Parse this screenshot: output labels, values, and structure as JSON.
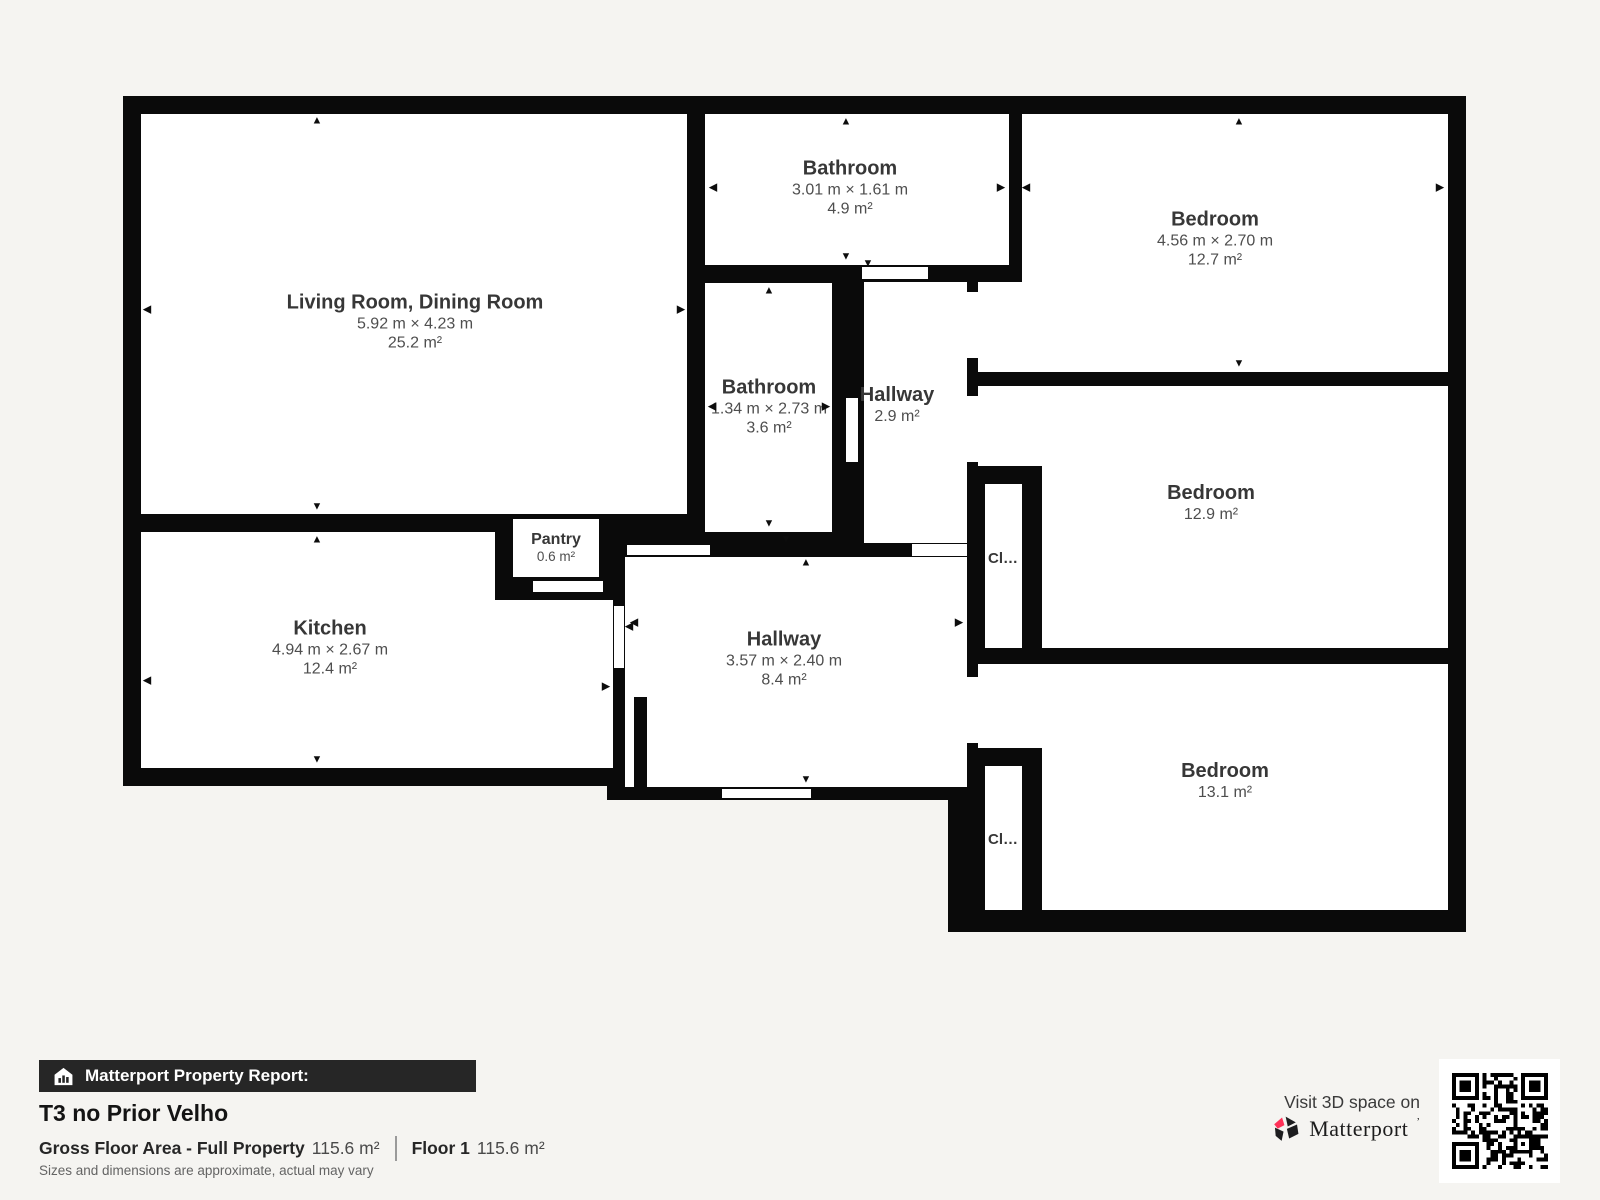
{
  "colors": {
    "wall": "#0a0a0a",
    "background": "#f5f4f1",
    "accent_pink": "#ff3158",
    "footer_bar": "#262626"
  },
  "footer": {
    "report_label": "Matterport Property Report:",
    "title": "T3 no Prior Velho",
    "gfa_label": "Gross Floor Area - Full Property",
    "gfa_value": "115.6 m²",
    "floor_label": "Floor 1",
    "floor_value": "115.6 m²",
    "disclaimer": "Sizes and dimensions are approximate, actual may vary",
    "visit_text": "Visit 3D space on",
    "brand": "Matterport",
    "brand_mark": "’"
  },
  "plan": {
    "black": [
      {
        "x": 123,
        "y": 96,
        "w": 1343,
        "h": 690
      },
      {
        "x": 948,
        "y": 96,
        "w": 518,
        "h": 836
      },
      {
        "x": 607,
        "y": 530,
        "w": 376,
        "h": 270
      }
    ],
    "white": [
      {
        "x": 141,
        "y": 114,
        "w": 546,
        "h": 400
      },
      {
        "x": 141,
        "y": 532,
        "w": 354,
        "h": 236
      },
      {
        "x": 141,
        "y": 600,
        "w": 472,
        "h": 168
      },
      {
        "x": 513,
        "y": 519,
        "w": 86,
        "h": 58
      },
      {
        "x": 705,
        "y": 114,
        "w": 304,
        "h": 151
      },
      {
        "x": 705,
        "y": 283,
        "w": 127,
        "h": 249
      },
      {
        "x": 864,
        "y": 282,
        "w": 103,
        "h": 261
      },
      {
        "x": 625,
        "y": 557,
        "w": 342,
        "h": 230
      },
      {
        "x": 978,
        "y": 282,
        "w": 44,
        "h": 90
      },
      {
        "x": 1022,
        "y": 114,
        "w": 426,
        "h": 258
      },
      {
        "x": 978,
        "y": 386,
        "w": 470,
        "h": 262
      },
      {
        "x": 978,
        "y": 664,
        "w": 470,
        "h": 246
      }
    ],
    "black2": [
      {
        "x": 978,
        "y": 466,
        "w": 64,
        "h": 182
      },
      {
        "x": 978,
        "y": 748,
        "w": 64,
        "h": 162
      },
      {
        "x": 634,
        "y": 697,
        "w": 13,
        "h": 90
      }
    ],
    "white2": [
      {
        "x": 985,
        "y": 484,
        "w": 37,
        "h": 164,
        "kind": "closet"
      },
      {
        "x": 985,
        "y": 766,
        "w": 37,
        "h": 144,
        "kind": "closet"
      },
      {
        "x": 862,
        "y": 267,
        "w": 66,
        "h": 12,
        "kind": "door"
      },
      {
        "x": 846,
        "y": 398,
        "w": 12,
        "h": 64,
        "kind": "door"
      },
      {
        "x": 967,
        "y": 292,
        "w": 11,
        "h": 66,
        "kind": "door"
      },
      {
        "x": 967,
        "y": 396,
        "w": 11,
        "h": 66,
        "kind": "door"
      },
      {
        "x": 967,
        "y": 677,
        "w": 11,
        "h": 66,
        "kind": "door"
      },
      {
        "x": 614,
        "y": 606,
        "w": 10,
        "h": 62,
        "kind": "door"
      },
      {
        "x": 533,
        "y": 581,
        "w": 70,
        "h": 11,
        "kind": "door"
      },
      {
        "x": 627,
        "y": 545,
        "w": 83,
        "h": 10,
        "kind": "door"
      },
      {
        "x": 722,
        "y": 789,
        "w": 89,
        "h": 9,
        "kind": "door"
      },
      {
        "x": 912,
        "y": 544,
        "w": 55,
        "h": 12,
        "kind": "door"
      }
    ],
    "labels": [
      {
        "key": "living-room",
        "style": "room",
        "cx": 415,
        "cy": 322,
        "name": "Living Room, Dining Room",
        "dims": "5.92 m × 4.23 m",
        "area": "25.2 m²"
      },
      {
        "key": "kitchen",
        "style": "room",
        "cx": 330,
        "cy": 648,
        "name": "Kitchen",
        "dims": "4.94 m × 2.67 m",
        "area": "12.4 m²"
      },
      {
        "key": "pantry",
        "style": "small",
        "cx": 556,
        "cy": 548,
        "name": "Pantry",
        "area": "0.6 m²"
      },
      {
        "key": "bathroom-top",
        "style": "room",
        "cx": 850,
        "cy": 188,
        "name": "Bathroom",
        "dims": "3.01 m × 1.61 m",
        "area": "4.9 m²"
      },
      {
        "key": "bathroom-middle",
        "style": "room",
        "cx": 769,
        "cy": 407,
        "name": "Bathroom",
        "dims": "1.34 m × 2.73 m",
        "area": "3.6 m²"
      },
      {
        "key": "hallway-small",
        "style": "room",
        "cx": 897,
        "cy": 405,
        "name": "Hallway",
        "area": "2.9 m²"
      },
      {
        "key": "hallway-main",
        "style": "room",
        "cx": 784,
        "cy": 659,
        "name": "Hallway",
        "dims": "3.57 m × 2.40 m",
        "area": "8.4 m²"
      },
      {
        "key": "bedroom-top",
        "style": "room",
        "cx": 1215,
        "cy": 239,
        "name": "Bedroom",
        "dims": "4.56 m × 2.70 m",
        "area": "12.7 m²"
      },
      {
        "key": "bedroom-middle",
        "style": "room",
        "cx": 1211,
        "cy": 503,
        "name": "Bedroom",
        "area": "12.9 m²"
      },
      {
        "key": "bedroom-bottom",
        "style": "room",
        "cx": 1225,
        "cy": 781,
        "name": "Bedroom",
        "area": "13.1 m²"
      },
      {
        "key": "closet-1",
        "style": "closet",
        "cx": 1003,
        "cy": 559,
        "name": "Cl…"
      },
      {
        "key": "closet-2",
        "style": "closet",
        "cx": 1003,
        "cy": 840,
        "name": "Cl…"
      }
    ],
    "arrows": [
      {
        "x": 317,
        "y": 121,
        "d": "up"
      },
      {
        "x": 317,
        "y": 507,
        "d": "down"
      },
      {
        "x": 147,
        "y": 310,
        "d": "left"
      },
      {
        "x": 681,
        "y": 310,
        "d": "right"
      },
      {
        "x": 317,
        "y": 540,
        "d": "up"
      },
      {
        "x": 317,
        "y": 760,
        "d": "down"
      },
      {
        "x": 147,
        "y": 681,
        "d": "left"
      },
      {
        "x": 606,
        "y": 687,
        "d": "right"
      },
      {
        "x": 629,
        "y": 627,
        "d": "left"
      },
      {
        "x": 846,
        "y": 122,
        "d": "up"
      },
      {
        "x": 846,
        "y": 257,
        "d": "down"
      },
      {
        "x": 713,
        "y": 188,
        "d": "left"
      },
      {
        "x": 1001,
        "y": 188,
        "d": "right"
      },
      {
        "x": 1026,
        "y": 188,
        "d": "left"
      },
      {
        "x": 1440,
        "y": 188,
        "d": "right"
      },
      {
        "x": 1239,
        "y": 122,
        "d": "up"
      },
      {
        "x": 1239,
        "y": 364,
        "d": "down"
      },
      {
        "x": 769,
        "y": 291,
        "d": "up"
      },
      {
        "x": 769,
        "y": 524,
        "d": "down"
      },
      {
        "x": 712,
        "y": 407,
        "d": "left"
      },
      {
        "x": 826,
        "y": 407,
        "d": "right"
      },
      {
        "x": 868,
        "y": 264,
        "d": "down"
      },
      {
        "x": 786,
        "y": 540,
        "d": "down"
      },
      {
        "x": 806,
        "y": 563,
        "d": "up"
      },
      {
        "x": 634,
        "y": 623,
        "d": "left"
      },
      {
        "x": 959,
        "y": 623,
        "d": "right"
      },
      {
        "x": 806,
        "y": 780,
        "d": "down"
      }
    ]
  }
}
